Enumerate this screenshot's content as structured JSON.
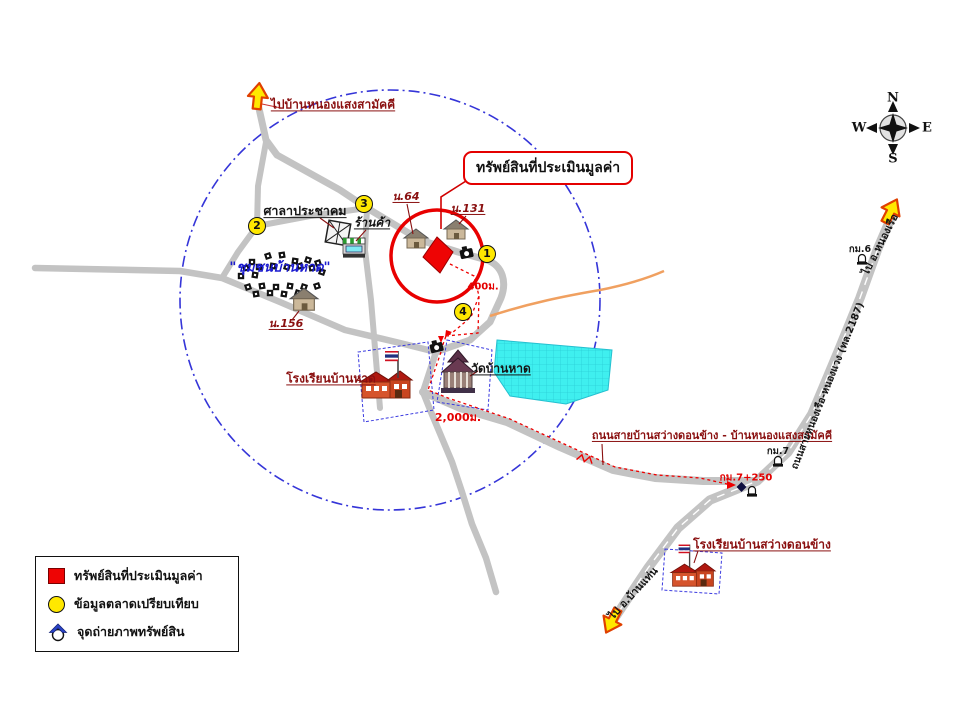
{
  "callout": {
    "text": "ทรัพย์สินที่ประเมินมูลค่า"
  },
  "arrows": {
    "top_left_label": "ไปบ้านหนองแสงสามัคคี",
    "top_right_label": "ไป อ.หนองเรือ",
    "bottom_label": "ไป อ.บ้านแท่น"
  },
  "places": {
    "community_hall": "ศาลาประชาคม",
    "shop": "ร้านค้า",
    "community": "\"ชุมชนบ้านหาด\"",
    "house64": "น.64",
    "house131": "น.131",
    "house156": "น.156",
    "school_banhat": "โรงเรียนบ้านหาด",
    "temple": "วัดบ้านหาด",
    "school_sawang": "โรงเรียนบ้านสว่างดอนข้าง"
  },
  "roads": {
    "east_west": "ถนนสายบ้านสว่างดอนข้าง - บ้านหนองแสงสามัคคี",
    "highway": "ถนนสายหนองเรือ-หนองแวง (ทล.2187)"
  },
  "markers": {
    "km6": "กม.6",
    "km7": "กม.7",
    "km7_250": "กม.7+250",
    "dist400": "400ม.",
    "dist2000": "2,000ม."
  },
  "numbers": {
    "n1": "1",
    "n2": "2",
    "n3": "3",
    "n4": "4"
  },
  "compass": {
    "n": "N",
    "e": "E",
    "s": "S",
    "w": "W"
  },
  "legend": {
    "items": [
      {
        "icon": "red-square",
        "label": "ทรัพย์สินที่ประเมินมูลค่า"
      },
      {
        "icon": "yellow-circle",
        "label": "ข้อมูลตลาดเปรียบเทียบ"
      },
      {
        "icon": "camera-point",
        "label": "จุดถ่ายภาพทรัพย์สิน"
      }
    ]
  },
  "colors": {
    "accent_red": "#EE0404",
    "marker_yellow": "#FFE800",
    "pond_cyan": "#3FEFEF",
    "road_gray": "#C3C3C3",
    "boundary_blue": "#3535D8",
    "label_maroon": "#8A1010",
    "community_blue": "#1A1AD0",
    "orange_road": "#F0A060"
  }
}
